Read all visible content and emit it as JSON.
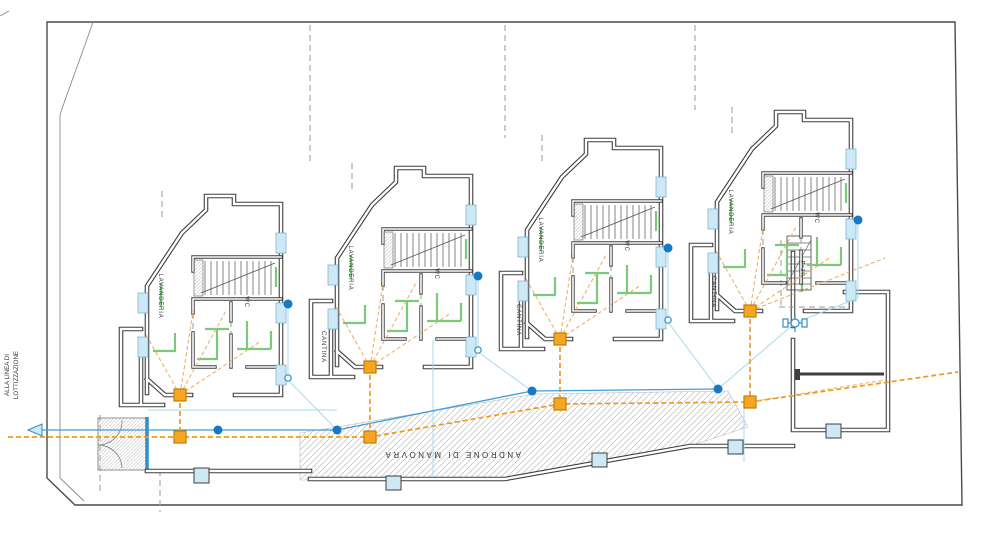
{
  "plan": {
    "rooms": {
      "laundry": "LAVANDERIA",
      "wc": "WC",
      "cellar": "CANTINA"
    },
    "annotations": {
      "slope": "P=2%",
      "maneuver_area": "ANDRONE DI MANOVRA",
      "to_lot_line_1": "ALLA LINEA DI",
      "to_lot_line_2": "LOTTIZZAZIONE"
    },
    "unit_count": 4,
    "colors": {
      "walls": "#3f3f3f",
      "sewer_line": "#ef9a1d",
      "sewer_node": "#f5a623",
      "water_line": "#3d9fd4",
      "water_node": "#1878c8",
      "vent_pipe": "#7cc97c",
      "opening_fill": "#cde9f6",
      "hatch": "#bdbdbd"
    }
  }
}
